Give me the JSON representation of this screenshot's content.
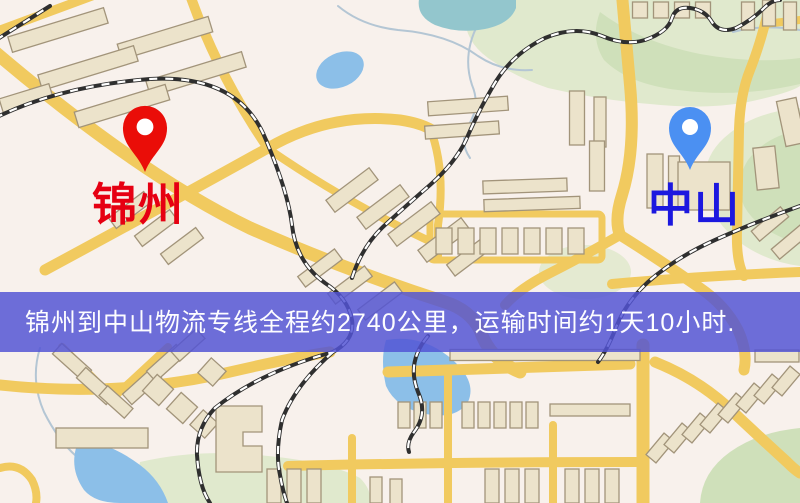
{
  "map": {
    "origin": {
      "label": "锦州",
      "label_color": "#e60012",
      "pin_color": "#ea0d08"
    },
    "destination": {
      "label": "中山",
      "label_color": "#1c18df",
      "pin_color": "#4b90f2"
    },
    "palette": {
      "background": "#f8f1ec",
      "road": "#f1ca5f",
      "building_fill": "#ece3cb",
      "building_stroke": "#a2947a",
      "park": "#cfe0ba",
      "park_light": "#e0e9cd",
      "water": "#8cbfe8",
      "pond": "#93c6cd",
      "stream": "#b4c6d4",
      "railway_dark": "#2f2f2f",
      "railway_light": "#ffffff",
      "pin_hole": "#ffffff"
    }
  },
  "banner": {
    "text": "锦州到中山物流专线全程约2740公里，运输时间约1天10小时.",
    "background": "#5254d4",
    "text_color": "#fdfdff"
  }
}
